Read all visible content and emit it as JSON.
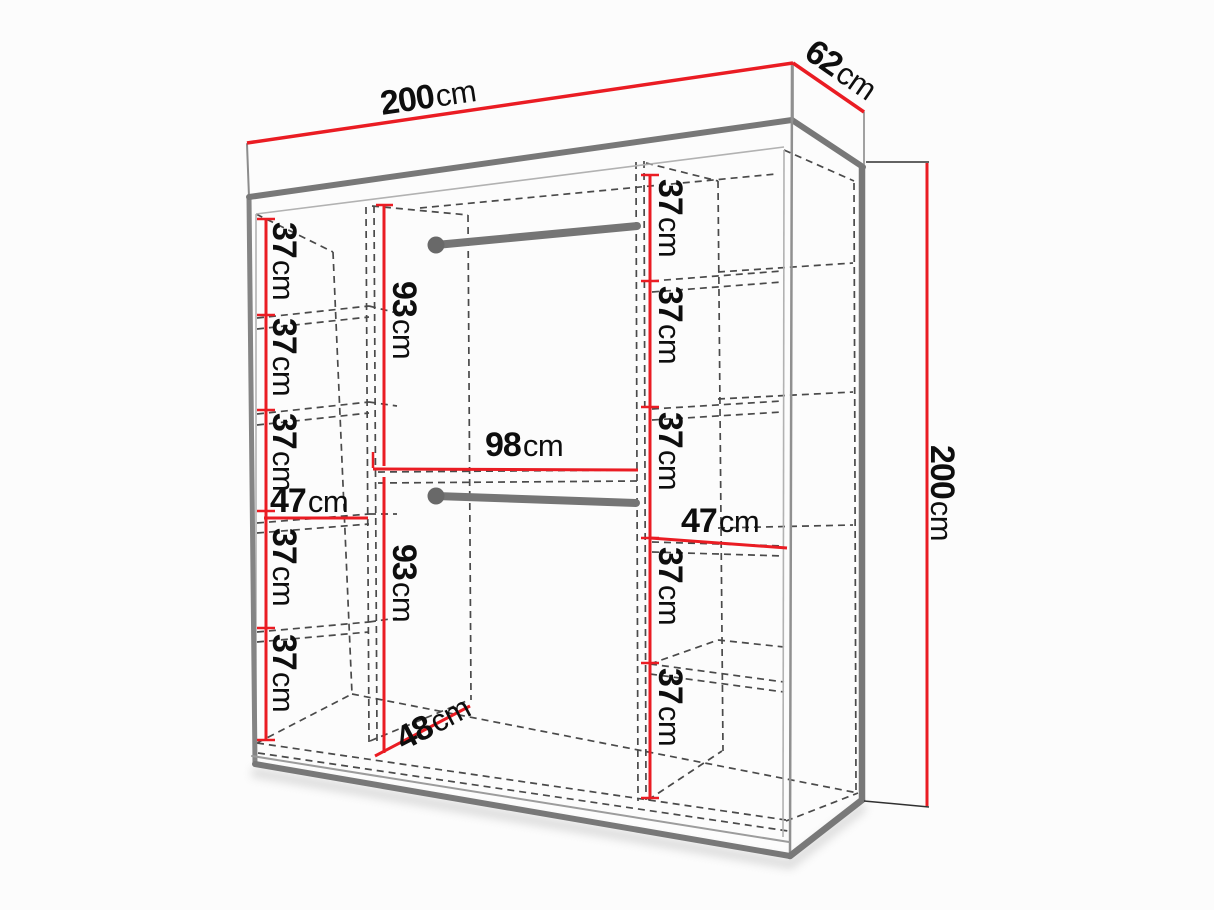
{
  "diagram_type": "wardrobe-dimension-diagram",
  "unit": "cm",
  "colors": {
    "dimension_line": "#ea1c23",
    "outline_gray": "#7a7a7a",
    "hidden_line": "#4a4a4a",
    "label_text": "#0e0e0e",
    "background": "#fcfcfc"
  },
  "dims": {
    "overall": {
      "width": {
        "value": "200",
        "unit": "cm"
      },
      "depth": {
        "value": "62",
        "unit": "cm"
      },
      "height": {
        "value": "200",
        "unit": "cm"
      }
    },
    "left_column": {
      "width": {
        "value": "47",
        "unit": "cm"
      },
      "sections": [
        {
          "value": "37",
          "unit": "cm"
        },
        {
          "value": "37",
          "unit": "cm"
        },
        {
          "value": "37",
          "unit": "cm"
        },
        {
          "value": "37",
          "unit": "cm"
        },
        {
          "value": "37",
          "unit": "cm"
        }
      ]
    },
    "middle_column": {
      "width": {
        "value": "98",
        "unit": "cm"
      },
      "floor_depth": {
        "value": "48",
        "unit": "cm"
      },
      "hanging_top": {
        "value": "93",
        "unit": "cm"
      },
      "hanging_bottom": {
        "value": "93",
        "unit": "cm"
      }
    },
    "right_column": {
      "width": {
        "value": "47",
        "unit": "cm"
      },
      "sections": [
        {
          "value": "37",
          "unit": "cm"
        },
        {
          "value": "37",
          "unit": "cm"
        },
        {
          "value": "37",
          "unit": "cm"
        },
        {
          "value": "37",
          "unit": "cm"
        },
        {
          "value": "37",
          "unit": "cm"
        }
      ]
    }
  }
}
